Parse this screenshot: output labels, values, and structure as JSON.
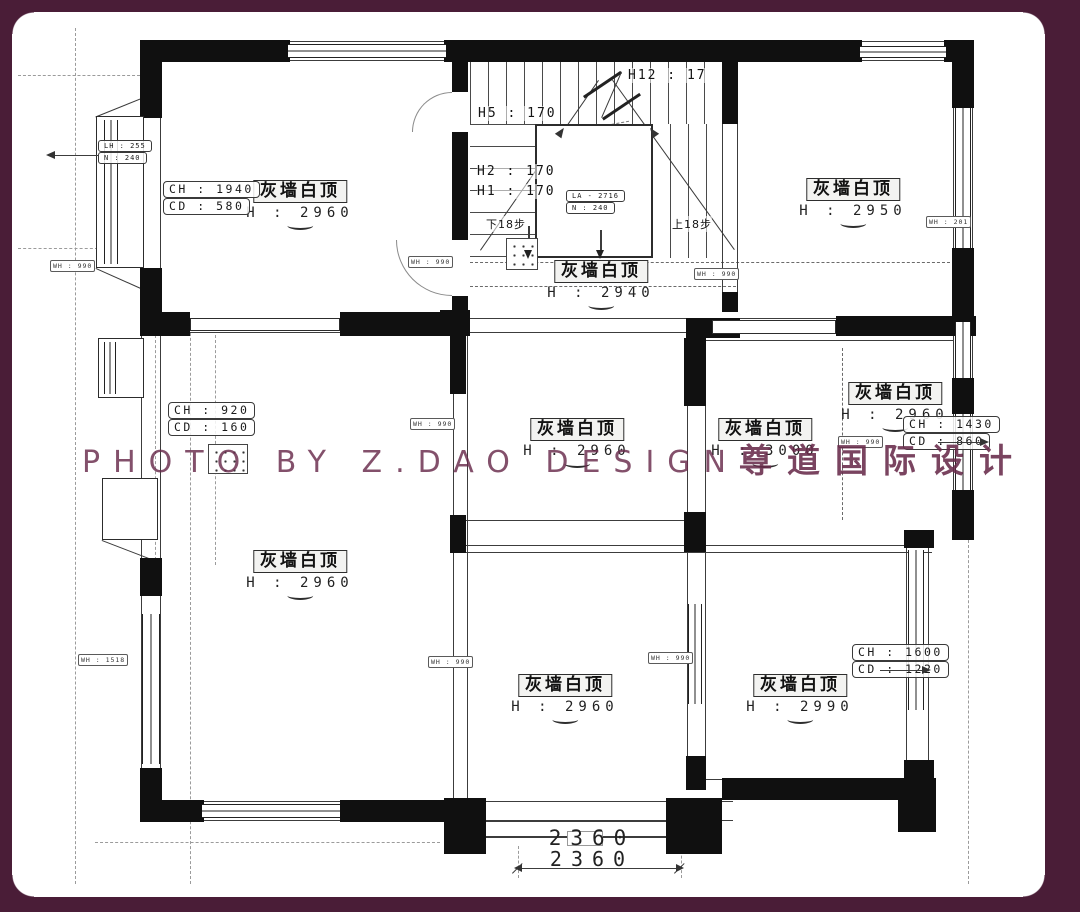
{
  "watermark": {
    "text_latin": "PHOTO BY Z.DAO DESIGN",
    "text_cjk": "尊道国际设计"
  },
  "colors": {
    "frame": "#4a1d37",
    "watermark": "#682a4a",
    "walls": "#101010"
  },
  "rooms": [
    {
      "id": "top-left",
      "name": "灰墙白顶",
      "height": "H : 2960"
    },
    {
      "id": "stair-hall",
      "name": "灰墙白顶",
      "height": "H : 2940"
    },
    {
      "id": "top-right",
      "name": "灰墙白顶",
      "height": "H : 2950"
    },
    {
      "id": "mid-center",
      "name": "灰墙白顶",
      "height": "H : 2960"
    },
    {
      "id": "mid-right-a",
      "name": "灰墙白顶",
      "height": "H : 3000"
    },
    {
      "id": "mid-right-b",
      "name": "灰墙白顶",
      "height": "H : 2960"
    },
    {
      "id": "mid-left",
      "name": "灰墙白顶",
      "height": "H : 2960"
    },
    {
      "id": "bottom-center",
      "name": "灰墙白顶",
      "height": "H : 2960"
    },
    {
      "id": "bottom-right",
      "name": "灰墙白顶",
      "height": "H : 2990"
    }
  ],
  "dim_tags": [
    {
      "line1": "CH : 1940",
      "line2": "CD : 580"
    },
    {
      "line1": "CH : 920",
      "line2": "CD : 160"
    },
    {
      "line1": "CH : 1430",
      "line2": "CD : 860"
    },
    {
      "line1": "CH : 1600",
      "line2": "CD : 1220"
    }
  ],
  "corner_tag": {
    "line1": "LH : 255",
    "line2": "N : 240"
  },
  "stair": {
    "h12": "H12 : 17",
    "h5": "H5 : 170",
    "h2": "H2 : 170",
    "h1": "H1 : 170",
    "down": "下18步",
    "up": "上18步",
    "box_line1": "LA - 2716",
    "box_line2": "N : 240"
  },
  "wall_tags": [
    {
      "text": "WH : 990"
    },
    {
      "text": "WH : 990"
    },
    {
      "text": "WH : 201"
    },
    {
      "text": "WH : 1518"
    },
    {
      "text": "WH : 990"
    },
    {
      "text": "WH : 990"
    },
    {
      "text": "WH : 990"
    },
    {
      "text": "WH : 990"
    },
    {
      "text": "WH : 990"
    }
  ],
  "bottom_dim": {
    "top": "2360",
    "bottom": "2360"
  }
}
